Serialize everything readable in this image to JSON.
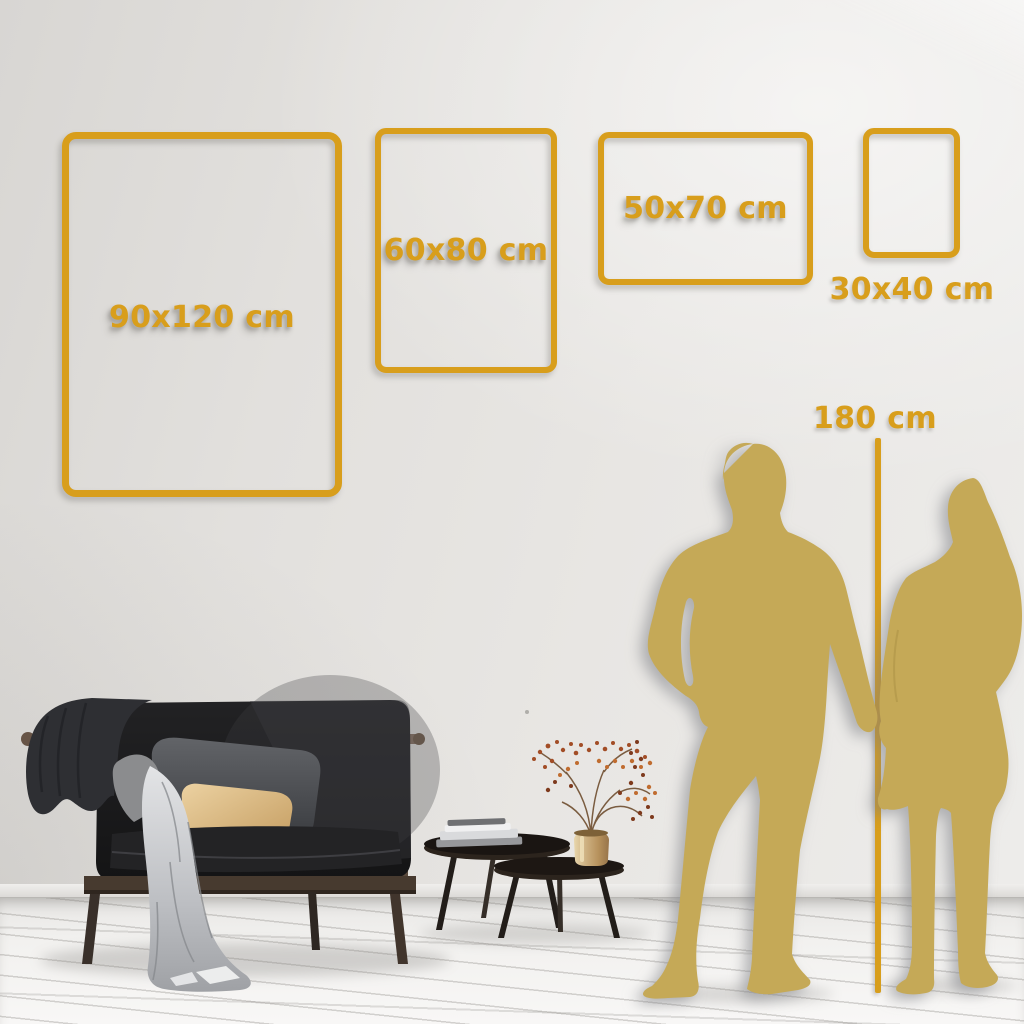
{
  "accent": {
    "gold": "#D89E1C",
    "silhouette_gold": "#C5A957"
  },
  "sizes": [
    {
      "label": "90x120 cm",
      "width_cm": 90,
      "height_cm": 120
    },
    {
      "label": "60x80 cm",
      "width_cm": 60,
      "height_cm": 80
    },
    {
      "label": "50x70 cm",
      "width_cm": 50,
      "height_cm": 70
    },
    {
      "label": "30x40 cm",
      "width_cm": 30,
      "height_cm": 40
    }
  ],
  "height_reference": {
    "label": "180 cm",
    "value_cm": 180
  },
  "scene": {
    "figures": [
      "man-silhouette",
      "woman-silhouette"
    ],
    "furniture": [
      "sofa",
      "nesting-coffee-tables",
      "brass-vase-with-dried-plant",
      "books",
      "blanket",
      "pillows"
    ]
  }
}
